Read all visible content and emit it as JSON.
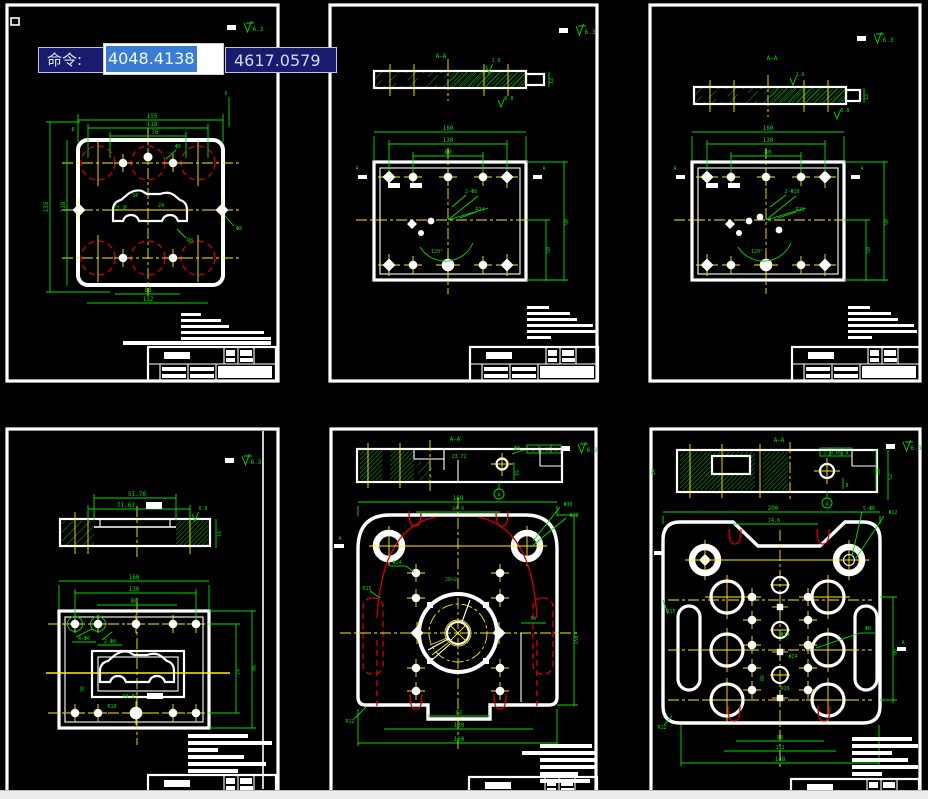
{
  "app": {
    "command_label": "命令:",
    "coord_x": "4048.4138",
    "coord_y": "4617.0579"
  },
  "colors": {
    "background": "#000000",
    "line_white": "#FFFFFF",
    "dim_green": "#00DE00",
    "centerline_yellow": "#FFEE00",
    "hidden_red": "#D40000",
    "tooltip_navy": "#191C6E",
    "selection_blue": "#3A7BD5",
    "bottom_strip_gray": "#EDEDED"
  },
  "sheets": {
    "s1": {
      "labels": [
        "155",
        "118",
        "76",
        "8",
        "6",
        "135",
        "118",
        "88",
        "132",
        "34",
        "24",
        "R8",
        "Φ6",
        "12",
        "20",
        "Φ8",
        "6.3"
      ]
    },
    "s2": {
      "labels": [
        "A—A",
        "12",
        "1.6",
        "0.8",
        "160",
        "130",
        "80",
        "2-Φ8",
        "R24",
        "120°",
        "50",
        "90",
        "A",
        "A",
        "6.3"
      ]
    },
    "s3": {
      "labels": [
        "A—A",
        "12",
        "1.6",
        "0.8",
        "160",
        "130",
        "80",
        "2-Φ10",
        "R26",
        "120°",
        "50",
        "90",
        "A",
        "A",
        "6.3"
      ]
    },
    "s4": {
      "labels": [
        "51.78",
        "71.63",
        "16",
        "0.8",
        "160",
        "130",
        "80",
        "4-Φ6",
        "2-Φ8",
        "74",
        "96",
        "59.87",
        "R10",
        "36",
        "6.3"
      ]
    },
    "s5": {
      "labels": [
        "A—A",
        "23.72",
        "Φ8",
        "15",
        "A",
        "168",
        "24.9",
        "Φ30",
        "Φ20",
        "Φ14",
        "20×2",
        "R15",
        "34",
        "150",
        "62",
        "130",
        "160",
        "R12",
        "A",
        "6.3",
        "◎",
        "0.05",
        "A"
      ]
    },
    "s6": {
      "labels": [
        "A—A",
        "24",
        "30",
        "52",
        "8",
        "A",
        "200",
        "74.8",
        "5-Φ8",
        "Φ12",
        "R15",
        "R12",
        "88",
        "112",
        "148",
        "96",
        "Φ8",
        "A",
        "Φ14",
        "Φ24",
        "R19",
        "86",
        "6.3",
        "◎",
        "0.05",
        "A"
      ]
    }
  }
}
